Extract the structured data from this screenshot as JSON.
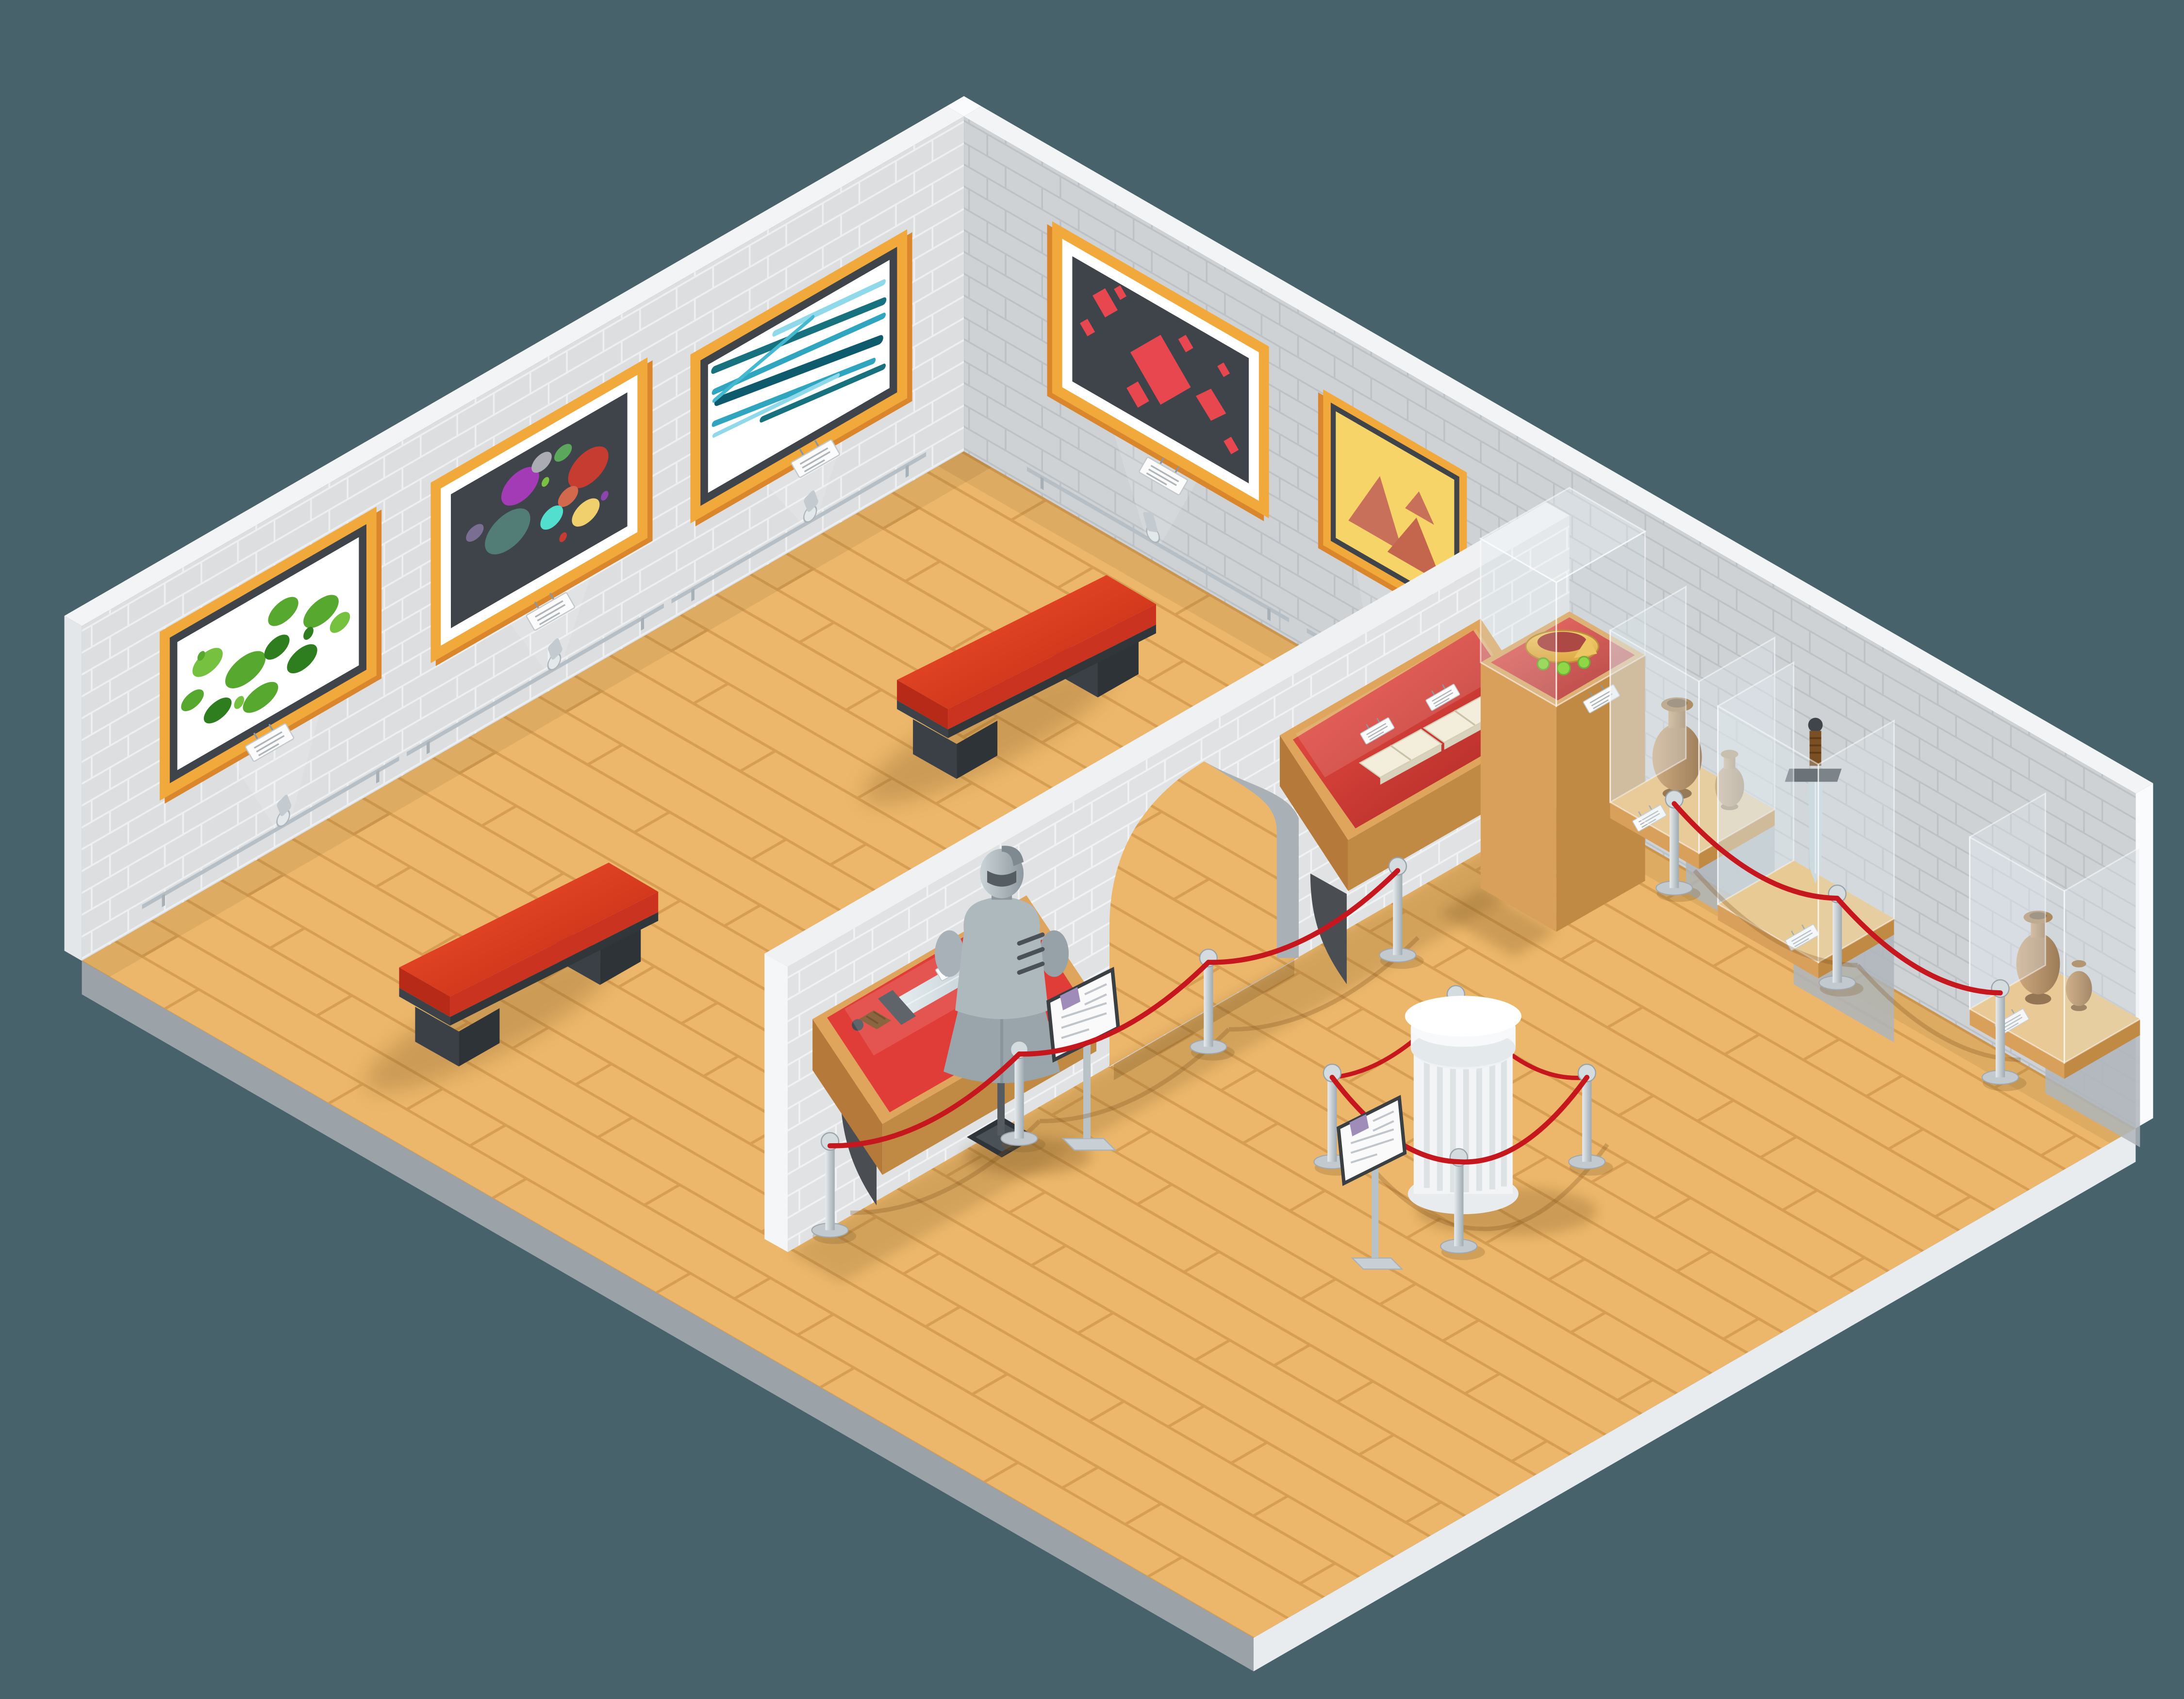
{
  "meta": {
    "title": "Isometric museum interior illustration — painting gallery wing and history exhibit hall",
    "style": "flat isometric vector, two rooms divided by an arched brick wall",
    "aspect": "4500x3500"
  },
  "colors": {
    "background": "#48626C",
    "wallTopWhite": "#F2F4F5",
    "wallNW": "#DCDEE0",
    "wallNE": "#CED2D5",
    "wallDivider": "#E0E2E4",
    "slabSW": "#9BA3A9",
    "slabSE": "#E9ECEE",
    "floorWood": "#ECB76B",
    "plankLine": "#D49A4E",
    "frameOrange": "#F2A93B",
    "frameEdge": "#D9862C",
    "frameInner": "#3E444A",
    "matWhite": "#FFFFFF",
    "canvasDark": "#3E444A",
    "canvasYellow": "#F6D468",
    "paintGreen": "#57A82E",
    "paintGreenDark": "#2E7D1E",
    "paintTeal": "#1B7F95",
    "paintRed": "#E8474F",
    "paintTerracotta": "#C9705B",
    "benchRed": "#E0371C",
    "benchLeg": "#2E3338",
    "ropeRed": "#C6171E",
    "stanchionSilver": "#C2CAD0",
    "caseWood": "#DFA55C",
    "caseWoodDark": "#C08A45",
    "velvetRed": "#E03C38",
    "velvetDark": "#9E1F1C",
    "glassTint": "rgba(223,233,238,0.35)",
    "armorSteel": "#AEB9BE",
    "swordSteel": "#C7D6DC",
    "gripBrown": "#7A4F23",
    "crownGold": "#F2B234",
    "gemGreen": "#7ED321",
    "vaseClay": "#B07B3F",
    "columnWhite": "#F2F4F5",
    "placardWhite": "#FBFBFB",
    "signPurple": "#A08CB8",
    "bracketDark": "#4A4E53"
  },
  "scene": {
    "type": "isometric museum cutaway",
    "rooms": [
      {
        "name": "painting-gallery-wing",
        "artworks": [
          {
            "id": "painting-green-foliage",
            "frame": "orange",
            "canvas": "white",
            "motif": "green paint dabs"
          },
          {
            "id": "painting-color-circles",
            "frame": "orange",
            "canvas": "dark grey",
            "motif": "multicolor ellipses"
          },
          {
            "id": "painting-teal-strokes",
            "frame": "orange",
            "canvas": "white",
            "motif": "teal diagonal strokes"
          },
          {
            "id": "painting-red-diamonds",
            "frame": "orange",
            "canvas": "dark grey",
            "motif": "red diamonds"
          },
          {
            "id": "painting-terracotta-triangles",
            "frame": "orange",
            "canvas": "yellow",
            "motif": "terracotta triangles",
            "note": "partially hidden behind divider wall"
          }
        ],
        "furniture": [
          {
            "id": "red-bench",
            "count": 2
          },
          {
            "id": "picture-spotlight-rail",
            "count": 5
          }
        ]
      },
      {
        "name": "history-exhibit-hall",
        "architecture": [
          {
            "id": "arched-doorway"
          }
        ],
        "exhibits": [
          {
            "id": "wall-case-sword",
            "desc": "wall-mounted wooden case, red velvet, short sword"
          },
          {
            "id": "knight-armor-stand",
            "desc": "plate armor torso and helmet on pole stand"
          },
          {
            "id": "wall-case-open-books",
            "desc": "two open manuscripts under glass"
          },
          {
            "id": "crown-pedestal",
            "desc": "gold crown with green gems on red cushion under tall glass case"
          },
          {
            "id": "marble-column",
            "desc": "white fluted column ringed by rope barrier"
          },
          {
            "id": "wall-shelf-amphorae",
            "count": 2,
            "desc": "clay vases on wooden shelves behind glass shields"
          },
          {
            "id": "wall-mounted-great-sword",
            "desc": "large sword hung above wooden shelf behind glass"
          },
          {
            "id": "rope-barrier",
            "stanchions": 11
          },
          {
            "id": "info-sign-stand",
            "count": 2
          }
        ]
      }
    ],
    "placards": {
      "count": 10,
      "text": "illegible miniature caption lines"
    }
  }
}
